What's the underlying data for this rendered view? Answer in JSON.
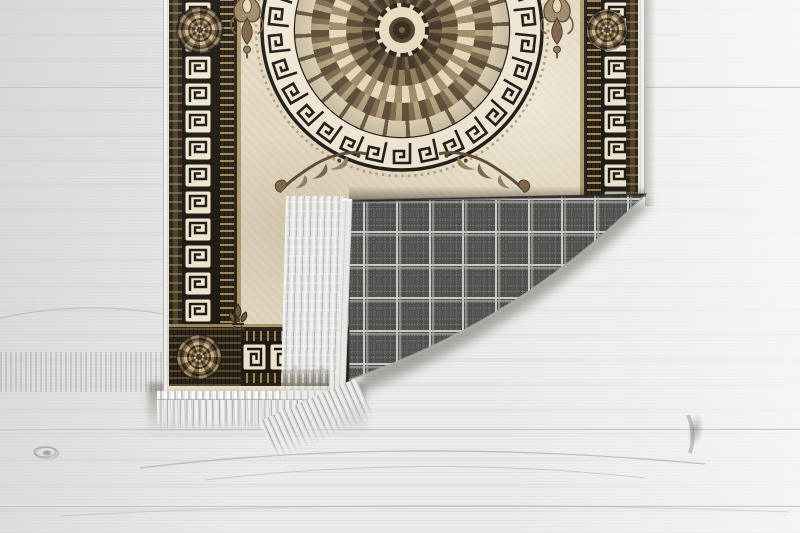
{
  "scene": {
    "description": "Product photograph of a beige Greek-key medallion rug with its bottom-right corner folded over, revealing a gray tartan woven backing and white fringe, lying on a whitewashed wood plank floor",
    "type": "product-photo"
  },
  "palette": {
    "floor": "#ececea",
    "floorShade": "#cdcdcb",
    "floorLight": "#f6f6f4",
    "seam": "#8c8c8a",
    "field": "#e5dbc4",
    "fieldDark": "#cfc2a4",
    "borderDark": "#241d13",
    "borderBlack": "#16120c",
    "keyCream": "#f2e9d4",
    "tanLine": "#a68f5f",
    "bronze": "#8a7350",
    "bronzeLight": "#c9ab7a",
    "bronzeDark": "#4a3a26",
    "medallionDark": "#3b2f20",
    "medallionMid": "#8a7556",
    "medallionCream": "#eadfc2",
    "plaidBase": "#4f4f4d",
    "plaidLight": "#c6c6c4",
    "plaidMid": "#74746e",
    "fringe": "#f0f0ee",
    "fringeShade": "#b3b3b1",
    "binding": "#e7e7e5",
    "shadow": "#6f6b63"
  },
  "rug": {
    "label": "Beige rug with black Greek-key meander borders and circular medallion",
    "motifs": {
      "border": "greek-key meander bands with dotted guard stripes",
      "medallion": "circular greek-key ring enclosing a brown floral mandala",
      "corner_rosettes": 3,
      "ring_keys": 30,
      "ornaments": [
        "damask-drop-left",
        "damask-drop-right",
        "acanthus-scroll-left",
        "acanthus-scroll-right",
        "corner-fleur"
      ]
    }
  },
  "fold": {
    "label": "Folded corner showing rug backing",
    "backing_pattern": "gray tartan plaid weave",
    "fringe_color": "white"
  },
  "floor_info": {
    "label": "Whitewashed wood plank floor",
    "seams_y": [
      86,
      428,
      505
    ]
  }
}
